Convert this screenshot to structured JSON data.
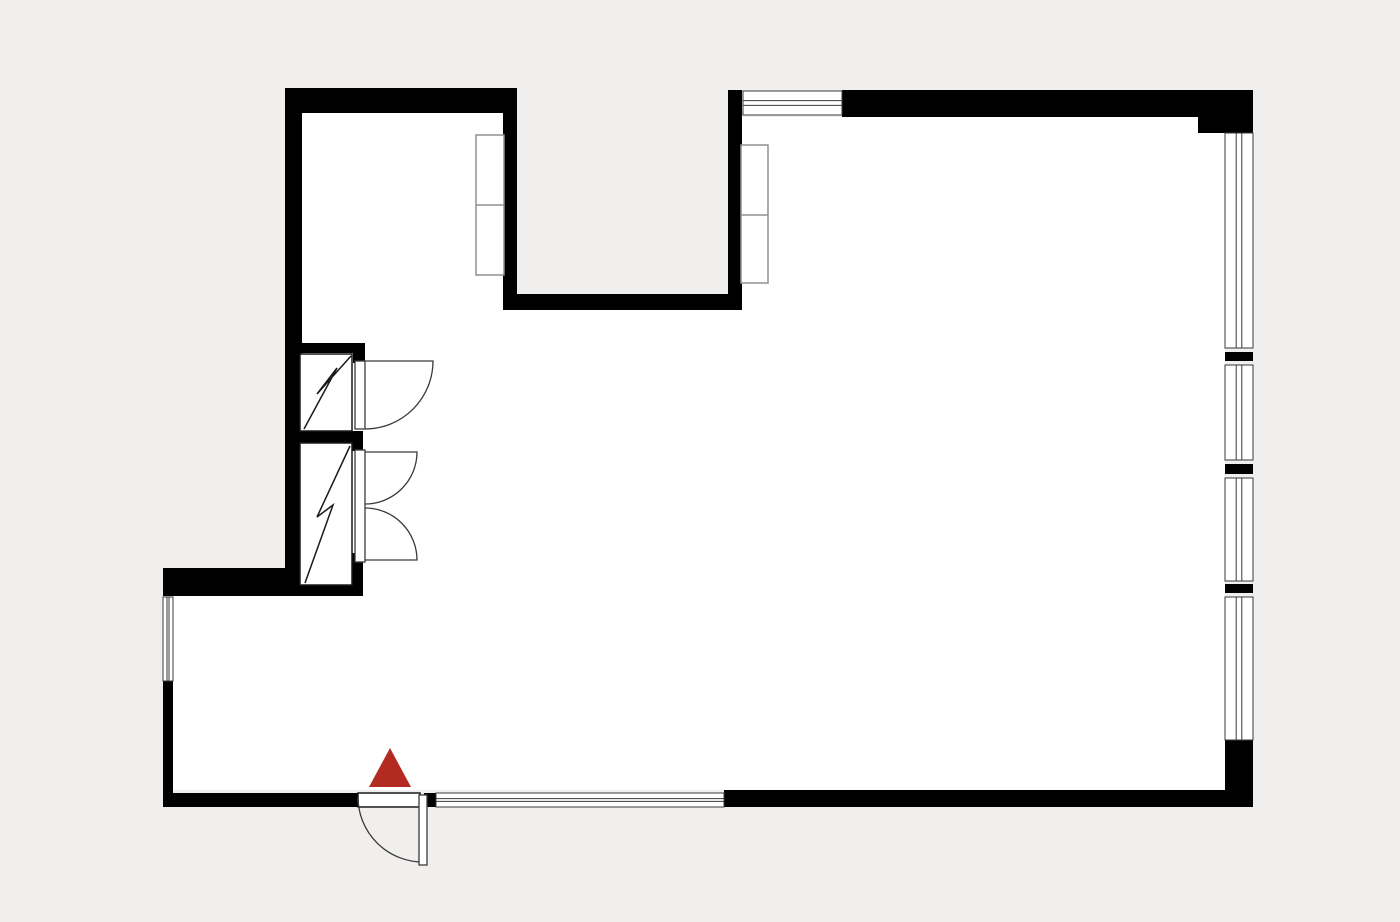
{
  "canvas": {
    "width": 1400,
    "height": 922,
    "background_color": "#f0efee",
    "floor_color": "#ffffff",
    "wall_color": "#000000",
    "feature_line_color": "#3a3a3a",
    "closet_line_color": "#1a1a1a",
    "furniture_line_color": "#909090",
    "marker_color": "#b32b20"
  },
  "floor_areas": [
    {
      "name": "floor-upper-left-room",
      "x": 301,
      "y": 113,
      "w": 204,
      "h": 677
    },
    {
      "name": "floor-center-room",
      "x": 505,
      "y": 309,
      "w": 237,
      "h": 481
    },
    {
      "name": "floor-right-room",
      "x": 742,
      "y": 117,
      "w": 483,
      "h": 673
    },
    {
      "name": "floor-bottom-left-room",
      "x": 173,
      "y": 595,
      "w": 190,
      "h": 195
    }
  ],
  "walls": [
    {
      "name": "wall-top-left",
      "x": 285,
      "y": 88,
      "w": 232,
      "h": 25
    },
    {
      "name": "wall-left",
      "x": 285,
      "y": 88,
      "w": 17,
      "h": 508
    },
    {
      "name": "wall-notch-left",
      "x": 503,
      "y": 88,
      "w": 14,
      "h": 222
    },
    {
      "name": "wall-notch-bottom",
      "x": 503,
      "y": 294,
      "w": 239,
      "h": 16
    },
    {
      "name": "wall-notch-right",
      "x": 728,
      "y": 90,
      "w": 14,
      "h": 220
    },
    {
      "name": "wall-top-right",
      "x": 842,
      "y": 90,
      "w": 411,
      "h": 27
    },
    {
      "name": "wall-top-right-step",
      "x": 1198,
      "y": 115,
      "w": 55,
      "h": 18
    },
    {
      "name": "wall-closet-top",
      "x": 285,
      "y": 343,
      "w": 80,
      "h": 10
    },
    {
      "name": "wall-closet-top-jamb",
      "x": 353,
      "y": 343,
      "w": 12,
      "h": 20
    },
    {
      "name": "wall-closet-separator",
      "x": 285,
      "y": 431,
      "w": 78,
      "h": 12
    },
    {
      "name": "wall-closet-separator-jamb",
      "x": 347,
      "y": 431,
      "w": 16,
      "h": 20
    },
    {
      "name": "wall-closet-bottom-jamb",
      "x": 347,
      "y": 553,
      "w": 16,
      "h": 43
    },
    {
      "name": "wall-closet-bottom-strip",
      "x": 300,
      "y": 585,
      "w": 47,
      "h": 11
    },
    {
      "name": "wall-bottom-left-band",
      "x": 163,
      "y": 568,
      "w": 122,
      "h": 28
    },
    {
      "name": "wall-left-lower",
      "x": 163,
      "y": 681,
      "w": 10,
      "h": 112
    },
    {
      "name": "wall-bottom-left",
      "x": 163,
      "y": 793,
      "w": 195,
      "h": 14
    },
    {
      "name": "wall-entry-door-pier",
      "x": 424,
      "y": 793,
      "w": 12,
      "h": 14
    },
    {
      "name": "wall-bottom-right",
      "x": 724,
      "y": 790,
      "w": 529,
      "h": 17
    },
    {
      "name": "wall-right-mullion-1",
      "x": 1225,
      "y": 352,
      "w": 28,
      "h": 9
    },
    {
      "name": "wall-right-mullion-2",
      "x": 1225,
      "y": 464,
      "w": 28,
      "h": 10
    },
    {
      "name": "wall-right-mullion-3",
      "x": 1225,
      "y": 584,
      "w": 28,
      "h": 9
    },
    {
      "name": "wall-right-bottom-corner",
      "x": 1225,
      "y": 740,
      "w": 28,
      "h": 67
    }
  ],
  "windows": [
    {
      "name": "window-top",
      "x": 743,
      "y": 91,
      "w": 99,
      "h": 24
    },
    {
      "name": "window-right-1",
      "x": 1225,
      "y": 133,
      "w": 28,
      "h": 215
    },
    {
      "name": "window-right-2",
      "x": 1225,
      "y": 365,
      "w": 28,
      "h": 95
    },
    {
      "name": "window-right-3",
      "x": 1225,
      "y": 478,
      "w": 28,
      "h": 103
    },
    {
      "name": "window-right-4",
      "x": 1225,
      "y": 597,
      "w": 28,
      "h": 143
    },
    {
      "name": "window-left",
      "x": 163,
      "y": 597,
      "w": 10,
      "h": 84
    },
    {
      "name": "window-bottom",
      "x": 436,
      "y": 793,
      "w": 288,
      "h": 14
    }
  ],
  "door_openings": [
    {
      "name": "entry-door-threshold",
      "x": 358,
      "y": 793,
      "w": 62,
      "h": 14
    }
  ],
  "door_arcs": [
    {
      "name": "entry-door-arc",
      "path": "M 358 797 A 65 65 0 0 0 423 862"
    },
    {
      "name": "closet-upper-door-arc",
      "path": "M 365 361 L 433 361 A 68 68 0 0 1 365 429"
    },
    {
      "name": "closet-lower-door-arc-top",
      "path": "M 365 452 L 417 452 A 52 52 0 0 1 365 504"
    },
    {
      "name": "closet-lower-door-arc-bottom",
      "path": "M 365 560 L 417 560 A 52 52 0 0 0 365 508"
    }
  ],
  "door_leaves": [
    {
      "name": "entry-door-leaf",
      "x": 419,
      "y": 795,
      "w": 8,
      "h": 70
    },
    {
      "name": "closet-upper-door-leaf",
      "x": 355,
      "y": 361,
      "w": 10,
      "h": 68
    },
    {
      "name": "closet-lower-door-leaf",
      "x": 355,
      "y": 450,
      "w": 10,
      "h": 112
    }
  ],
  "closets": [
    {
      "name": "closet-upper",
      "x": 300,
      "y": 354,
      "w": 52,
      "h": 77,
      "zigzag": "304,429 337,368 317,394 351,356"
    },
    {
      "name": "closet-lower",
      "x": 300,
      "y": 443,
      "w": 52,
      "h": 142,
      "zigzag": "305,583 333,505 317,517 350,446"
    }
  ],
  "furniture": [
    {
      "name": "cabinet-upper-left",
      "x": 476,
      "y": 135,
      "w": 28,
      "h": 140,
      "divider_y": 205
    },
    {
      "name": "cabinet-right-wall",
      "x": 741,
      "y": 145,
      "w": 27,
      "h": 138,
      "divider_y": 215
    }
  ],
  "marker": {
    "name": "position-marker-triangle",
    "points": "390,748 369,787 411,787"
  }
}
